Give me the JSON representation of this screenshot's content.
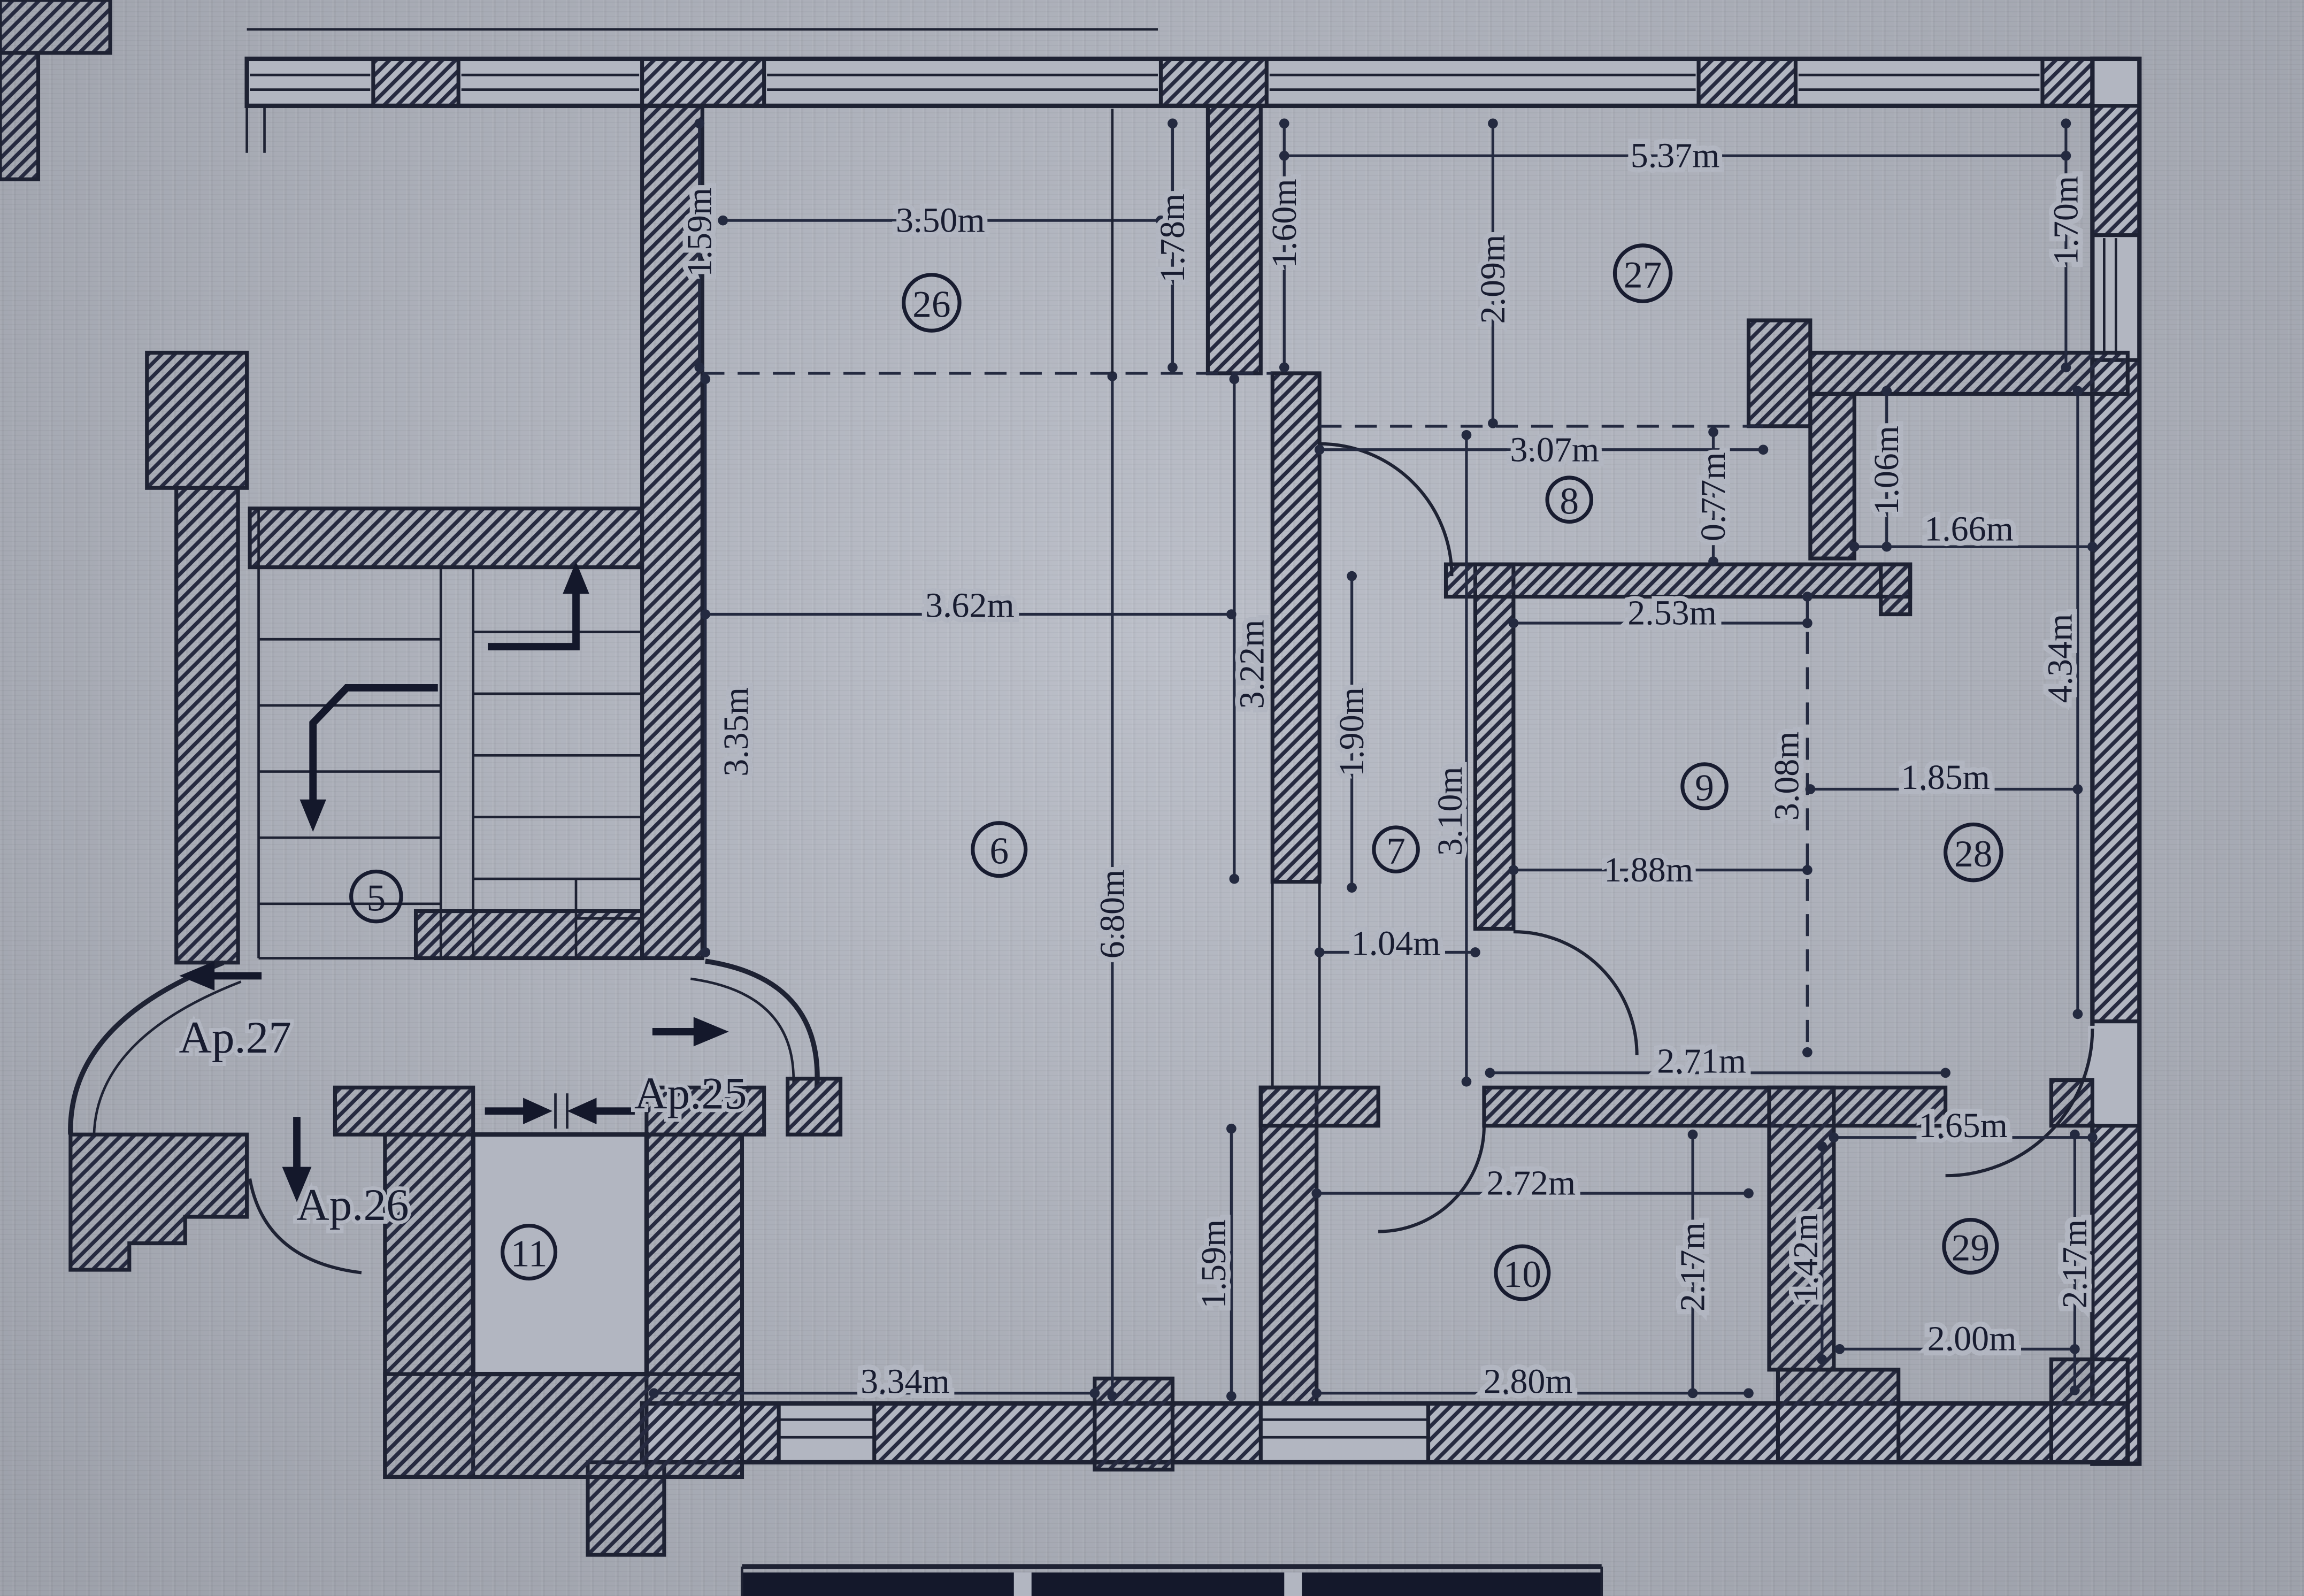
{
  "drawing": {
    "type": "apartment-floor-plan",
    "palette": {
      "paper": "#b2b6c1",
      "ink": "#1e2233"
    },
    "units": "m"
  },
  "rooms": [
    {
      "n": "5"
    },
    {
      "n": "6"
    },
    {
      "n": "7"
    },
    {
      "n": "8"
    },
    {
      "n": "9"
    },
    {
      "n": "10"
    },
    {
      "n": "11"
    },
    {
      "n": "26"
    },
    {
      "n": "27"
    },
    {
      "n": "28"
    },
    {
      "n": "29"
    }
  ],
  "dims": [
    {
      "t": "1.59m"
    },
    {
      "t": "3.50m"
    },
    {
      "t": "1.78m"
    },
    {
      "t": "1.60m"
    },
    {
      "t": "2.09m"
    },
    {
      "t": "5.37m"
    },
    {
      "t": "1.70m"
    },
    {
      "t": "3.07m"
    },
    {
      "t": "0.77m"
    },
    {
      "t": "1.06m"
    },
    {
      "t": "1.66m"
    },
    {
      "t": "2.53m"
    },
    {
      "t": "4.34m"
    },
    {
      "t": "3.08m"
    },
    {
      "t": "1.85m"
    },
    {
      "t": "1.88m"
    },
    {
      "t": "3.62m"
    },
    {
      "t": "3.35m"
    },
    {
      "t": "3.22m"
    },
    {
      "t": "6.80m"
    },
    {
      "t": "1.90m"
    },
    {
      "t": "3.10m"
    },
    {
      "t": "1.04m"
    },
    {
      "t": "2.71m"
    },
    {
      "t": "1.65m"
    },
    {
      "t": "2.72m"
    },
    {
      "t": "2.17m"
    },
    {
      "t": "1.42m"
    },
    {
      "t": "2.17m"
    },
    {
      "t": "2.00m"
    },
    {
      "t": "3.34m"
    },
    {
      "t": "2.80m"
    },
    {
      "t": "1.59m"
    }
  ],
  "apartments": [
    {
      "t": "Ap.27"
    },
    {
      "t": "Ap.25"
    },
    {
      "t": "Ap.26"
    }
  ]
}
